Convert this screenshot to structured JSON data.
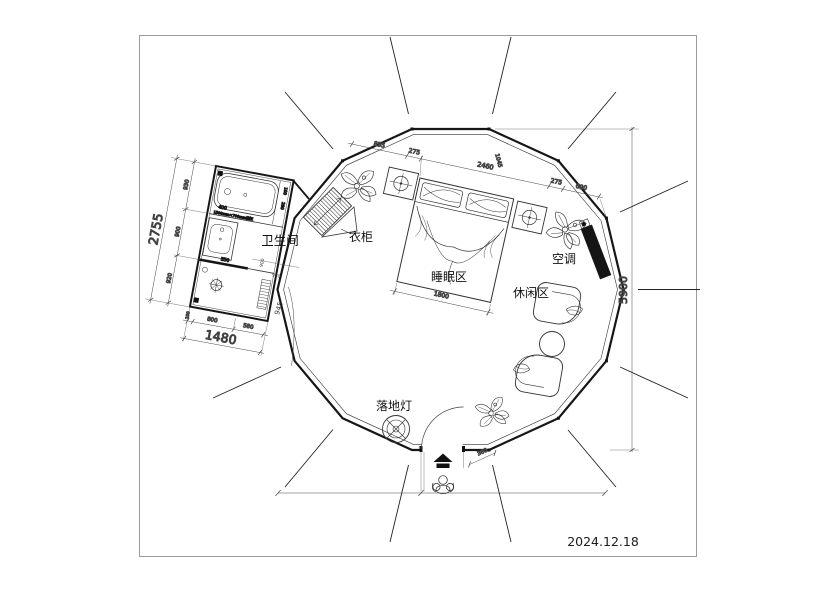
{
  "meta": {
    "date": "2024.12.18"
  },
  "rooms": {
    "bathroom": "卫生间",
    "wardrobe": "衣柜",
    "sleeping_area": "睡眠区",
    "leisure_area": "休闲区",
    "air_conditioner": "空调",
    "floor_lamp": "落地灯"
  },
  "dims": {
    "top_chain": {
      "a": "835",
      "b": "275",
      "c": "2460",
      "d": "1045",
      "e": "275",
      "f": "690"
    },
    "height_total": "5900",
    "bed_width": "1800",
    "door_width": "360",
    "gap": "945",
    "bath_left": {
      "a": "930",
      "b": "900",
      "c": "920",
      "total": "2755"
    },
    "bath_bottom": {
      "a": "100",
      "b": "800",
      "c": "580",
      "total": "1480"
    },
    "bath_inner": {
      "tub": "400",
      "sink": "550",
      "v": "900",
      "h": "930",
      "s1": "100",
      "s2": "280"
    },
    "tub_note": "1500mm×700mm浴缸"
  }
}
